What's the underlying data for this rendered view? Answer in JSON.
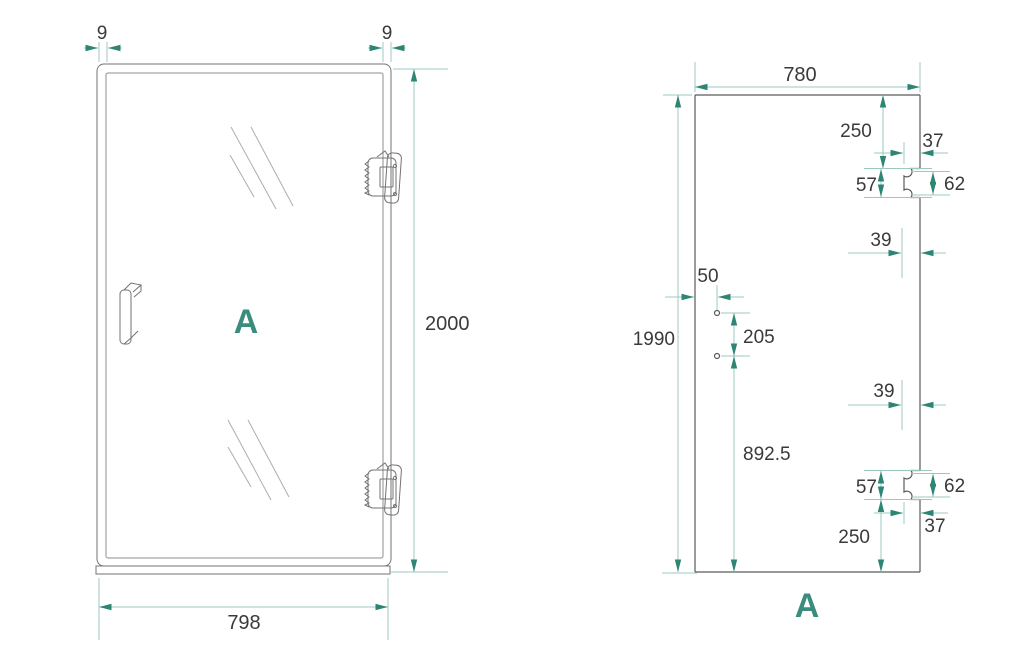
{
  "drawing_title": "Shower door technical drawing",
  "colors": {
    "accent_teal": "#3a8c7c",
    "dimension_line": "#9cc8c0",
    "arrow": "#2d8573",
    "door_outline": "#737373",
    "panel_outline": "#5a5a5a",
    "text": "#3a3a3a",
    "background": "#ffffff"
  },
  "left_view": {
    "label": "A",
    "frame_offset_left": "9",
    "frame_offset_right": "9",
    "door_height": "2000",
    "door_width": "798"
  },
  "right_view": {
    "label": "A",
    "glass_width": "780",
    "glass_height": "1990",
    "top_hinge": {
      "from_top": "250",
      "edge_inset": "37",
      "cut_height": "57",
      "plate_height": "62",
      "hole_offset": "39"
    },
    "handle": {
      "from_edge": "50",
      "hole_spacing": "205",
      "lower_hole_from_bottom": "892.5"
    },
    "bottom_hinge": {
      "hole_offset": "39",
      "cut_height": "57",
      "plate_height": "62",
      "edge_inset": "37",
      "from_bottom": "250"
    }
  }
}
